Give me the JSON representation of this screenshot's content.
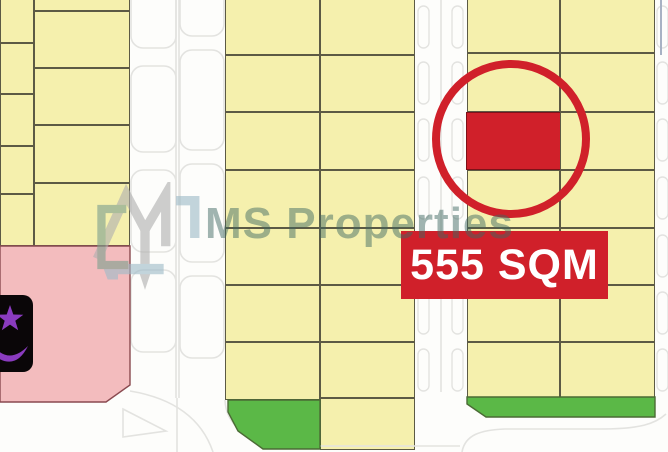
{
  "watermark": {
    "brand": "MS Properties",
    "logo_icon": "ms-monogram",
    "text_color": "#3e6861"
  },
  "highlight": {
    "area_label": "555 SQM",
    "accent_color": "#d0202a",
    "banner": {
      "x": 401,
      "y": 231,
      "w": 207,
      "h": 68
    },
    "circle": {
      "cx": 511,
      "cy": 139,
      "r": 75,
      "stroke_width": 8
    }
  },
  "map": {
    "colors": {
      "plot": "#f5f0ad",
      "plot_border": "#5c5a45",
      "pink": "#f3bcbe",
      "pink_border": "#8a4a50",
      "green": "#5bb847",
      "green_border": "#4b6b35",
      "road_line": "#e3e3e0",
      "red": "#d0202a",
      "mosque_fill": "#0a0608",
      "mosque_symbol": "#8a3bbf",
      "steel_line": "#a8b2c4"
    },
    "mosque": {
      "x": -12,
      "y": 295,
      "w": 45,
      "h": 77,
      "symbol": "star-and-crescent"
    },
    "plots": [
      {
        "x": 0,
        "y": -6,
        "w": 34,
        "h": 49
      },
      {
        "x": 0,
        "y": 43,
        "w": 34,
        "h": 51
      },
      {
        "x": 0,
        "y": 94,
        "w": 34,
        "h": 52
      },
      {
        "x": 0,
        "y": 146,
        "w": 34,
        "h": 48
      },
      {
        "x": 0,
        "y": 194,
        "w": 34,
        "h": 52
      },
      {
        "x": 34,
        "y": -8,
        "w": 96,
        "h": 19
      },
      {
        "x": 34,
        "y": 11,
        "w": 96,
        "h": 57
      },
      {
        "x": 34,
        "y": 68,
        "w": 96,
        "h": 57
      },
      {
        "x": 34,
        "y": 125,
        "w": 96,
        "h": 58
      },
      {
        "x": 34,
        "y": 183,
        "w": 96,
        "h": 63
      },
      {
        "x": 225,
        "y": -8,
        "w": 95,
        "h": 63
      },
      {
        "x": 225,
        "y": 55,
        "w": 95,
        "h": 57
      },
      {
        "x": 225,
        "y": 112,
        "w": 95,
        "h": 58
      },
      {
        "x": 225,
        "y": 170,
        "w": 95,
        "h": 58
      },
      {
        "x": 225,
        "y": 228,
        "w": 95,
        "h": 57
      },
      {
        "x": 225,
        "y": 285,
        "w": 95,
        "h": 57
      },
      {
        "x": 225,
        "y": 342,
        "w": 95,
        "h": 58
      },
      {
        "x": 320,
        "y": -8,
        "w": 95,
        "h": 63
      },
      {
        "x": 320,
        "y": 55,
        "w": 95,
        "h": 57
      },
      {
        "x": 320,
        "y": 112,
        "w": 95,
        "h": 58
      },
      {
        "x": 320,
        "y": 170,
        "w": 95,
        "h": 58
      },
      {
        "x": 320,
        "y": 228,
        "w": 95,
        "h": 57
      },
      {
        "x": 320,
        "y": 285,
        "w": 95,
        "h": 57
      },
      {
        "x": 320,
        "y": 342,
        "w": 95,
        "h": 56
      },
      {
        "x": 320,
        "y": 398,
        "w": 95,
        "h": 52
      },
      {
        "x": 467,
        "y": -8,
        "w": 93,
        "h": 61
      },
      {
        "x": 467,
        "y": 53,
        "w": 93,
        "h": 59
      },
      {
        "x": 466,
        "y": 112,
        "w": 95,
        "h": 58,
        "t": "red"
      },
      {
        "x": 467,
        "y": 170,
        "w": 93,
        "h": 58
      },
      {
        "x": 467,
        "y": 228,
        "w": 93,
        "h": 57
      },
      {
        "x": 467,
        "y": 285,
        "w": 93,
        "h": 57
      },
      {
        "x": 467,
        "y": 342,
        "w": 93,
        "h": 56
      },
      {
        "x": 560,
        "y": -8,
        "w": 95,
        "h": 61
      },
      {
        "x": 560,
        "y": 53,
        "w": 95,
        "h": 59
      },
      {
        "x": 560,
        "y": 112,
        "w": 95,
        "h": 58
      },
      {
        "x": 560,
        "y": 170,
        "w": 95,
        "h": 58
      },
      {
        "x": 560,
        "y": 228,
        "w": 95,
        "h": 57
      },
      {
        "x": 560,
        "y": 285,
        "w": 95,
        "h": 57
      },
      {
        "x": 560,
        "y": 342,
        "w": 95,
        "h": 56
      }
    ],
    "polygons": [
      {
        "name": "pink-plot",
        "type": "pink",
        "points": "0,246 130,246 130,385 106,402 0,402"
      },
      {
        "name": "green-plot",
        "type": "green",
        "points": "228,400 320,400 320,449 263,449 238,431 228,412"
      },
      {
        "name": "green-plot",
        "type": "green",
        "points": "467,397 655,397 655,417 486,417 467,404"
      }
    ],
    "roads": {
      "lines": [
        "M176,0 V398",
        "M179,0 V398",
        "M441,0 V392",
        "M130,391 Q196,402 213,452",
        "M177,398 V452",
        "M225,400 C226,425 245,440 285,446 L460,446",
        "M462,452 C465,435 480,430 505,429 L600,429 C640,429 655,424 666,414"
      ],
      "island": "M123,409 L166,431 L123,437 Z",
      "steel_line": "M661,0 V55",
      "bays": [
        {
          "x": 131,
          "y": -28,
          "w": 45,
          "h": 76
        },
        {
          "x": 131,
          "y": 66,
          "w": 45,
          "h": 86
        },
        {
          "x": 131,
          "y": 170,
          "w": 45,
          "h": 82
        },
        {
          "x": 131,
          "y": 270,
          "w": 45,
          "h": 82
        },
        {
          "x": 180,
          "y": -18,
          "w": 44,
          "h": 54
        },
        {
          "x": 180,
          "y": 50,
          "w": 44,
          "h": 100
        },
        {
          "x": 180,
          "y": 164,
          "w": 44,
          "h": 98
        },
        {
          "x": 180,
          "y": 276,
          "w": 44,
          "h": 82
        }
      ],
      "pill_columns": [
        418,
        452,
        657
      ],
      "pill_rows": [
        6,
        62,
        119,
        177,
        235,
        292,
        349
      ],
      "pill_size": [
        11,
        42
      ]
    }
  }
}
